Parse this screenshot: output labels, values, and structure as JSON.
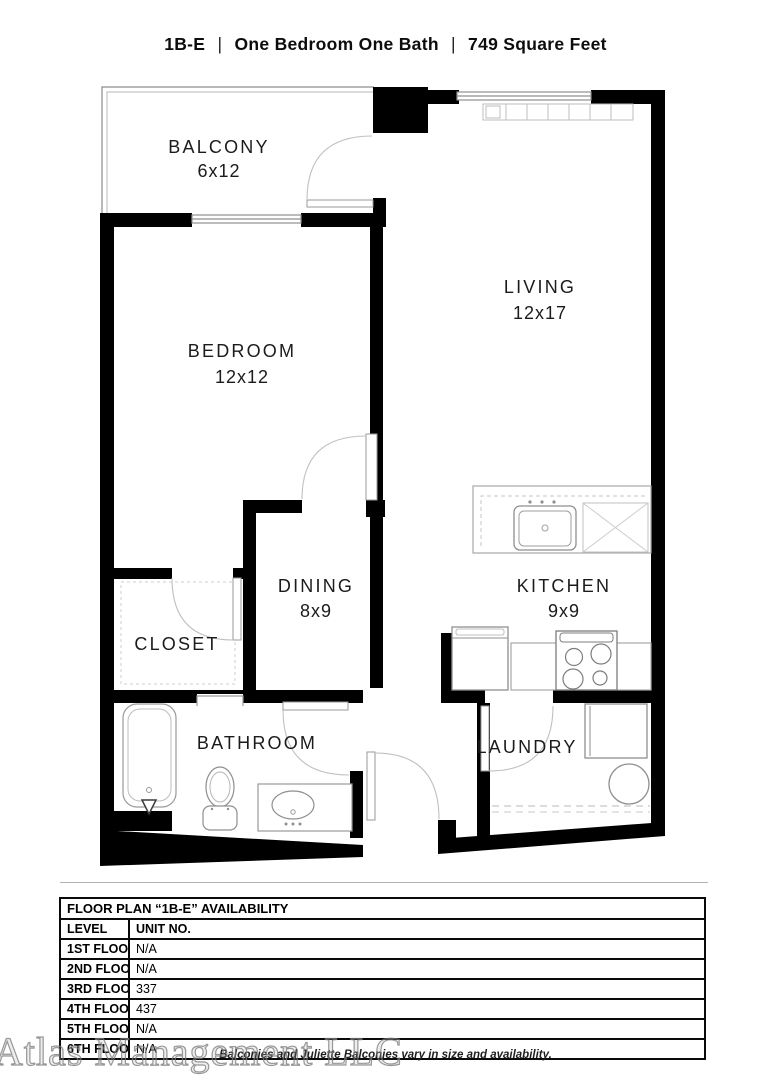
{
  "header": {
    "plan_code": "1B-E",
    "separator": "|",
    "description": "One Bedroom One Bath",
    "area": "749 Square Feet"
  },
  "floor_plan": {
    "rooms": [
      {
        "id": "balcony",
        "name": "BALCONY",
        "dims": "6x12"
      },
      {
        "id": "living",
        "name": "LIVING",
        "dims": "12x17"
      },
      {
        "id": "bedroom",
        "name": "BEDROOM",
        "dims": "12x12"
      },
      {
        "id": "dining",
        "name": "DINING",
        "dims": "8x9"
      },
      {
        "id": "kitchen",
        "name": "KITCHEN",
        "dims": "9x9"
      },
      {
        "id": "closet",
        "name": "CLOSET",
        "dims": ""
      },
      {
        "id": "bathroom",
        "name": "BATHROOM",
        "dims": ""
      },
      {
        "id": "laundry",
        "name": "LAUNDRY",
        "dims": ""
      }
    ],
    "fixtures": [
      "bathtub",
      "toilet",
      "vanity-sink",
      "kitchen-sink",
      "dishwasher",
      "refrigerator",
      "stove",
      "washer",
      "dryer",
      "window-bench"
    ]
  },
  "availability_table": {
    "title": "FLOOR PLAN “1B-E” AVAILABILITY",
    "columns": [
      "LEVEL",
      "UNIT NO."
    ],
    "rows": [
      {
        "level": "1ST FLOOR",
        "unit": "N/A"
      },
      {
        "level": "2ND FLOOR",
        "unit": "N/A"
      },
      {
        "level": "3RD FLOOR",
        "unit": "337"
      },
      {
        "level": "4TH FLOOR",
        "unit": "437"
      },
      {
        "level": "5TH FLOOR",
        "unit": "N/A"
      },
      {
        "level": "6TH FLOOR",
        "unit": "N/A"
      }
    ]
  },
  "footer": {
    "disclaimer": "Balconies and Juliette Balconies vary in size and availability.",
    "watermark": "Atlas Management LLC"
  },
  "colors": {
    "wall": "#000000",
    "fixture_outline": "#8f8f8f",
    "text": "#1b1b1b"
  }
}
